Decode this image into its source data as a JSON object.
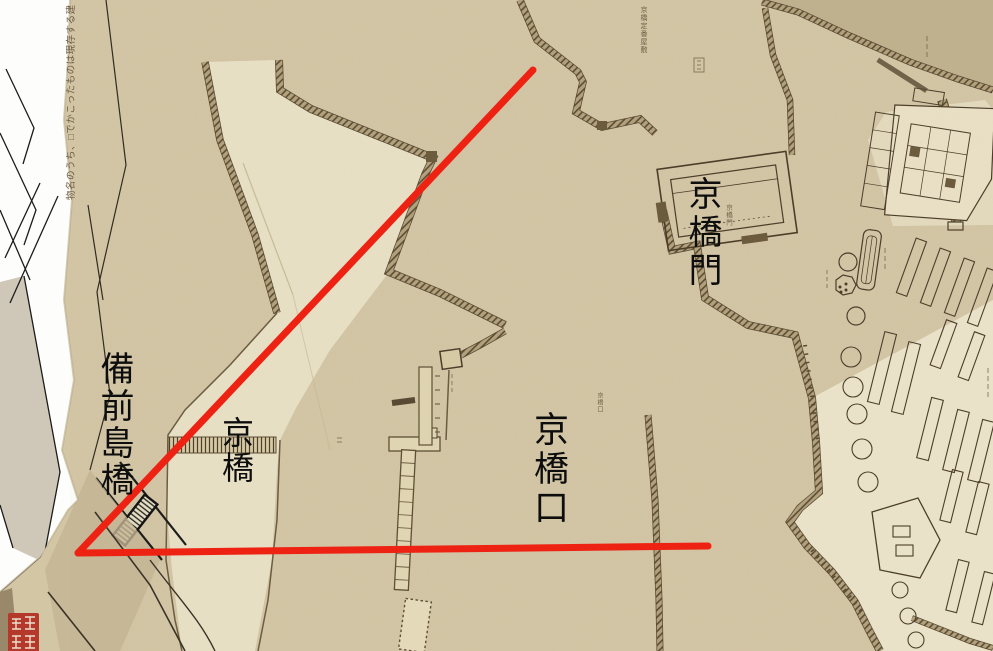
{
  "labels": {
    "overlay": [
      {
        "id": "bizenjimabashi",
        "text": "備前島橋"
      },
      {
        "id": "kyobashi",
        "text": "京橋"
      },
      {
        "id": "kyobashiguchi",
        "text": "京橋口"
      },
      {
        "id": "kyobashimon",
        "text": "京橋門"
      }
    ],
    "map_print": [
      {
        "id": "kyobashi-joban-yashiki",
        "text": "京橋定番屋敷"
      },
      {
        "id": "kyobashimon-small",
        "text": "京橋門"
      },
      {
        "id": "kyobashiguchi-small",
        "text": "京橋口"
      }
    ],
    "legend_note": "物名のうち、□でかこったものは現存する建"
  },
  "annotations": {
    "color": "#ee2213",
    "line_width": 7,
    "lines": [
      {
        "id": "diagonal",
        "x1": 533,
        "y1": 70,
        "x2": 78,
        "y2": 553
      },
      {
        "id": "horizontal",
        "x1": 78,
        "y1": 553,
        "x2": 708,
        "y2": 546
      }
    ]
  },
  "seal": {
    "color": "#b5392b",
    "glyph_color": "#ecdfce"
  },
  "palette": {
    "paper": "#d3c6a5",
    "moat_water": "#e9e1c6",
    "wall_hatch_dark": "#54462e",
    "wall_hatch_base": "#b3a27c",
    "modern_map_bg": "#fdfdfb",
    "outer_water_dark": "#c1b28f",
    "inner_ground_light": "#ece4ca"
  }
}
